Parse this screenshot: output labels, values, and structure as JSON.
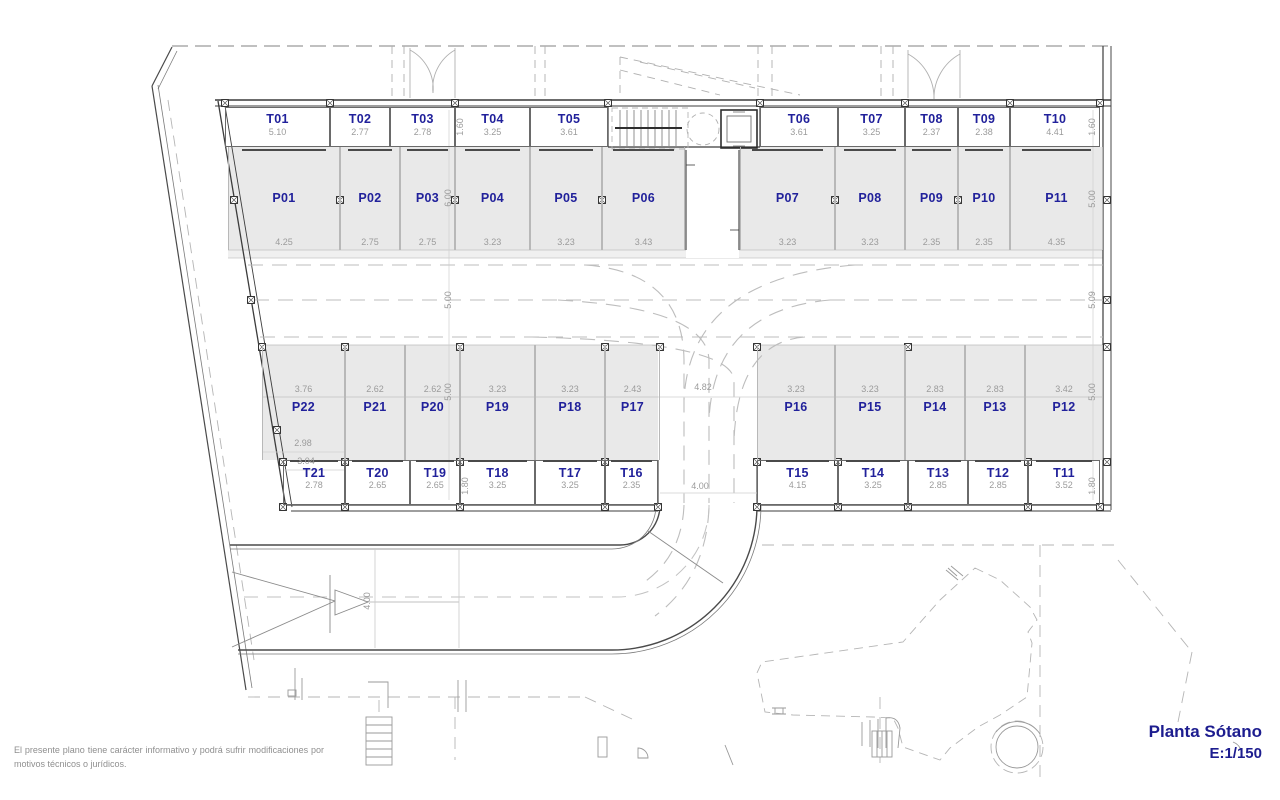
{
  "title": {
    "name": "Planta Sótano",
    "scale": "E:1/150"
  },
  "disclaimer": {
    "line1": "El presente plano tiene carácter informativo y podrá sufrir",
    "line2": "modificaciones por motivos técnicos o jurídicos."
  },
  "colors": {
    "accent_blue": "#21219b",
    "dim_gray": "#9b9b9b",
    "fill_gray": "#e9e9e9",
    "wall": "#3c3c3c"
  },
  "plan": {
    "storage_top": [
      {
        "id": "T01",
        "dim": "5.10",
        "x": 225,
        "w": 105
      },
      {
        "id": "T02",
        "dim": "2.77",
        "x": 330,
        "w": 60
      },
      {
        "id": "T03",
        "dim": "2.78",
        "x": 390,
        "w": 65
      },
      {
        "id": "T04",
        "dim": "3.25",
        "x": 455,
        "w": 75
      },
      {
        "id": "T05",
        "dim": "3.61",
        "x": 530,
        "w": 78
      },
      {
        "id": "T06",
        "dim": "3.61",
        "x": 760,
        "w": 78
      },
      {
        "id": "T07",
        "dim": "3.25",
        "x": 838,
        "w": 67
      },
      {
        "id": "T08",
        "dim": "2.37",
        "x": 905,
        "w": 53
      },
      {
        "id": "T09",
        "dim": "2.38",
        "x": 958,
        "w": 52
      },
      {
        "id": "T10",
        "dim": "4.41",
        "x": 1010,
        "w": 90
      }
    ],
    "parking_top": [
      {
        "id": "P01",
        "dim": "4.25",
        "x": 228,
        "w": 112
      },
      {
        "id": "P02",
        "dim": "2.75",
        "x": 340,
        "w": 60
      },
      {
        "id": "P03",
        "dim": "2.75",
        "x": 400,
        "w": 55
      },
      {
        "id": "P04",
        "dim": "3.23",
        "x": 455,
        "w": 75
      },
      {
        "id": "P05",
        "dim": "3.23",
        "x": 530,
        "w": 72
      },
      {
        "id": "P06",
        "dim": "3.43",
        "x": 602,
        "w": 83
      },
      {
        "id": "P07",
        "dim": "3.23",
        "x": 740,
        "w": 95
      },
      {
        "id": "P08",
        "dim": "3.23",
        "x": 835,
        "w": 70
      },
      {
        "id": "P09",
        "dim": "2.35",
        "x": 905,
        "w": 53
      },
      {
        "id": "P10",
        "dim": "2.35",
        "x": 958,
        "w": 52
      },
      {
        "id": "P11",
        "dim": "4.35",
        "x": 1010,
        "w": 93
      }
    ],
    "parking_bottom": [
      {
        "id": "P22",
        "dim": "3.76",
        "x": 262,
        "w": 83
      },
      {
        "id": "P21",
        "dim": "2.62",
        "x": 345,
        "w": 60
      },
      {
        "id": "P20",
        "dim": "2.62",
        "x": 405,
        "w": 55
      },
      {
        "id": "P19",
        "dim": "3.23",
        "x": 460,
        "w": 75
      },
      {
        "id": "P18",
        "dim": "3.23",
        "x": 535,
        "w": 70
      },
      {
        "id": "P17",
        "dim": "2.43",
        "x": 605,
        "w": 55
      },
      {
        "id": "P16",
        "dim": "3.23",
        "x": 757,
        "w": 78
      },
      {
        "id": "P15",
        "dim": "3.23",
        "x": 835,
        "w": 70
      },
      {
        "id": "P14",
        "dim": "2.83",
        "x": 905,
        "w": 60
      },
      {
        "id": "P13",
        "dim": "2.83",
        "x": 965,
        "w": 60
      },
      {
        "id": "P12",
        "dim": "3.42",
        "x": 1025,
        "w": 78
      }
    ],
    "storage_bottom": [
      {
        "id": "T21",
        "dim": "2.78",
        "x": 283,
        "w": 62
      },
      {
        "id": "T20",
        "dim": "2.65",
        "x": 345,
        "w": 65
      },
      {
        "id": "T19",
        "dim": "2.65",
        "x": 410,
        "w": 50
      },
      {
        "id": "T18",
        "dim": "3.25",
        "x": 460,
        "w": 75
      },
      {
        "id": "T17",
        "dim": "3.25",
        "x": 535,
        "w": 70
      },
      {
        "id": "T16",
        "dim": "2.35",
        "x": 605,
        "w": 53
      },
      {
        "id": "T15",
        "dim": "4.15",
        "x": 757,
        "w": 81
      },
      {
        "id": "T14",
        "dim": "3.25",
        "x": 838,
        "w": 70
      },
      {
        "id": "T13",
        "dim": "2.85",
        "x": 908,
        "w": 60
      },
      {
        "id": "T12",
        "dim": "2.85",
        "x": 968,
        "w": 60
      },
      {
        "id": "T11",
        "dim": "3.52",
        "x": 1028,
        "w": 72
      }
    ],
    "vdims": [
      {
        "text": "1.60",
        "x": 461,
        "y": 127
      },
      {
        "text": "6.00",
        "x": 449,
        "y": 198
      },
      {
        "text": "5.00",
        "x": 449,
        "y": 300
      },
      {
        "text": "5.00",
        "x": 449,
        "y": 392
      },
      {
        "text": "1.80",
        "x": 466,
        "y": 486
      },
      {
        "text": "1.60",
        "x": 1093,
        "y": 127
      },
      {
        "text": "5.00",
        "x": 1093,
        "y": 199
      },
      {
        "text": "5.09",
        "x": 1093,
        "y": 300
      },
      {
        "text": "5.00",
        "x": 1093,
        "y": 392
      },
      {
        "text": "1.80",
        "x": 1093,
        "y": 486
      },
      {
        "text": "4.00",
        "x": 368,
        "y": 601
      }
    ],
    "hdims": [
      {
        "text": "4.82",
        "x": 703,
        "y": 388
      },
      {
        "text": "4.00",
        "x": 700,
        "y": 487
      },
      {
        "text": "2.98",
        "x": 303,
        "y": 444
      },
      {
        "text": "3.04",
        "x": 306,
        "y": 462
      }
    ],
    "columns": [
      [
        225,
        103
      ],
      [
        330,
        103
      ],
      [
        455,
        103
      ],
      [
        608,
        103
      ],
      [
        760,
        103
      ],
      [
        905,
        103
      ],
      [
        1010,
        103
      ],
      [
        1100,
        103
      ],
      [
        234,
        200
      ],
      [
        340,
        200
      ],
      [
        455,
        200
      ],
      [
        602,
        200
      ],
      [
        835,
        200
      ],
      [
        958,
        200
      ],
      [
        1107,
        200
      ],
      [
        251,
        300
      ],
      [
        1107,
        300
      ],
      [
        262,
        347
      ],
      [
        345,
        347
      ],
      [
        460,
        347
      ],
      [
        605,
        347
      ],
      [
        660,
        347
      ],
      [
        757,
        347
      ],
      [
        908,
        347
      ],
      [
        1107,
        347
      ],
      [
        277,
        430
      ],
      [
        283,
        462
      ],
      [
        345,
        462
      ],
      [
        460,
        462
      ],
      [
        605,
        462
      ],
      [
        757,
        462
      ],
      [
        838,
        462
      ],
      [
        1028,
        462
      ],
      [
        1107,
        462
      ],
      [
        283,
        507
      ],
      [
        345,
        507
      ],
      [
        460,
        507
      ],
      [
        605,
        507
      ],
      [
        658,
        507
      ],
      [
        757,
        507
      ],
      [
        838,
        507
      ],
      [
        908,
        507
      ],
      [
        1028,
        507
      ],
      [
        1100,
        507
      ]
    ]
  }
}
